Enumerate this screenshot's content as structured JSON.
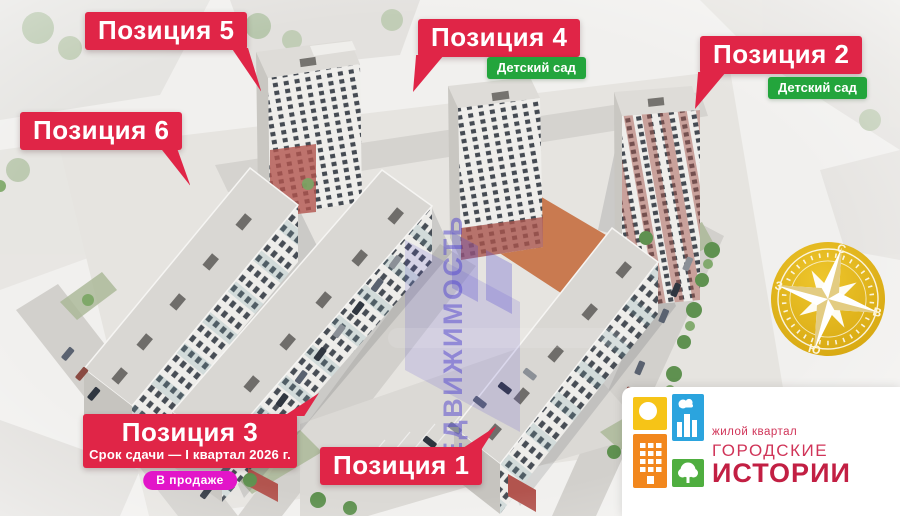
{
  "labels": {
    "pos1": {
      "title": "Позиция 1"
    },
    "pos2": {
      "title": "Позиция 2",
      "badge": "Детский сад"
    },
    "pos3": {
      "title": "Позиция 3",
      "subtitle": "Срок сдачи — I квартал 2026 г.",
      "badge": "В продаже"
    },
    "pos4": {
      "title": "Позиция 4",
      "badge": "Детский сад"
    },
    "pos5": {
      "title": "Позиция 5"
    },
    "pos6": {
      "title": "Позиция 6"
    }
  },
  "watermark": {
    "text": "НЕДВИЖИМОСТЬ"
  },
  "compass": {
    "north": "С",
    "east": "В",
    "south": "Ю",
    "west": "З"
  },
  "logo": {
    "tagline": "жилой квартал",
    "name_line1": "ГОРОДСКИЕ",
    "name_line2": "ИСТОРИИ"
  },
  "colors": {
    "label_red": "#e02547",
    "badge_green": "#23a53c",
    "badge_magenta": "#e215c9",
    "compass_gold": "#dfb013",
    "logo_crimson": "#c21f43",
    "tile_yellow": "#f6c417",
    "tile_blue": "#2ba4de",
    "tile_orange": "#f2871d",
    "tile_green": "#4fae3f",
    "watermark_purple": "#5a4ed0"
  }
}
